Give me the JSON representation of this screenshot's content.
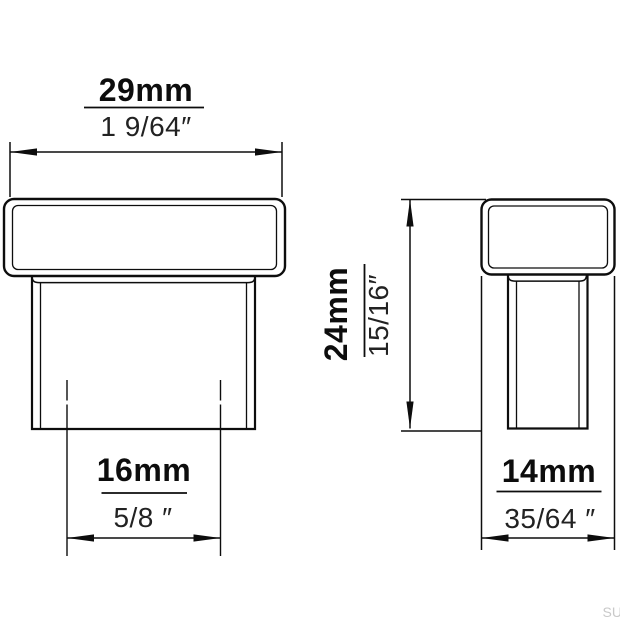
{
  "watermark": "SU",
  "views": {
    "front": {
      "width_mm": "29mm",
      "width_inch": "1 9/64″",
      "boss_mm": "16mm",
      "boss_inch": "5/8 ″"
    },
    "side": {
      "height_mm": "24mm",
      "height_inch": "15/16″",
      "depth_mm": "14mm",
      "depth_inch": "35/64 ″"
    }
  }
}
